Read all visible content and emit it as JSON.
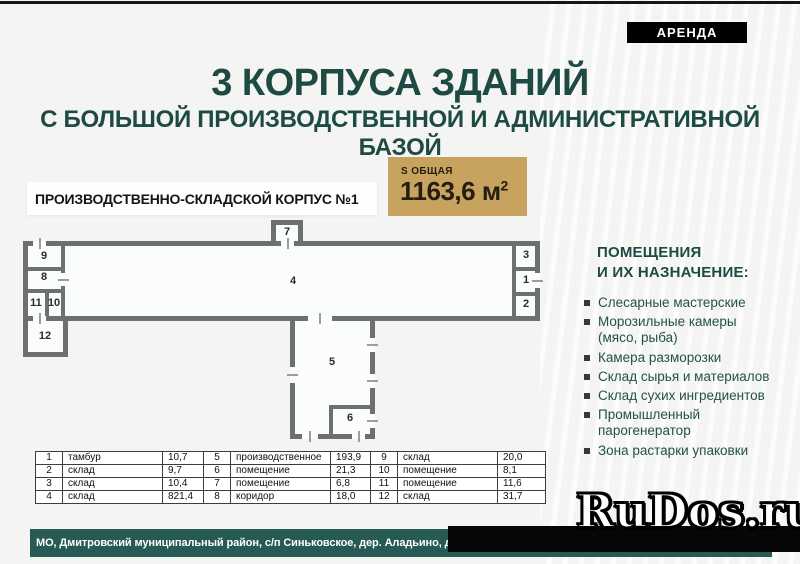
{
  "top": {
    "rent_badge": "АРЕНДА"
  },
  "header": {
    "title": "3 КОРПУСА ЗДАНИЙ",
    "subtitle": "С БОЛЬШОЙ ПРОИЗВОДСТВЕННОЙ И АДМИНИСТРАТИВНОЙ БАЗОЙ"
  },
  "building": {
    "name": "ПРОИЗВОДСТВЕННО-СКЛАДСКОЙ КОРПУС №1",
    "area_caption": "S ОБЩАЯ",
    "area_value": "1163,6 м",
    "area_sup": "2"
  },
  "floor_plan": {
    "room_labels": [
      "1",
      "2",
      "3",
      "4",
      "5",
      "6",
      "7",
      "8",
      "9",
      "10",
      "11",
      "12"
    ]
  },
  "legend": {
    "title_line1": "ПОМЕЩЕНИЯ",
    "title_line2": "И ИХ НАЗНАЧЕНИЕ:",
    "items": [
      "Слесарные мастерские",
      "Морозильные камеры (мясо, рыба)",
      "Камера разморозки",
      "Склад сырья и материалов",
      "Склад сухих ингредиентов",
      "Промышленный парогенератор",
      "Зона растарки упаковки"
    ]
  },
  "tables": [
    {
      "rows": [
        [
          "1",
          "тамбур",
          "10,7"
        ],
        [
          "2",
          "склад",
          "9,7"
        ],
        [
          "3",
          "склад",
          "10,4"
        ],
        [
          "4",
          "склад",
          "821,4"
        ]
      ]
    },
    {
      "rows": [
        [
          "5",
          "производственное",
          "193,9"
        ],
        [
          "6",
          "помещение",
          "21,3"
        ],
        [
          "7",
          "помещение",
          "6,8"
        ],
        [
          "8",
          "коридор",
          "18,0"
        ]
      ]
    },
    {
      "rows": [
        [
          "9",
          "склад",
          "20,0"
        ],
        [
          "10",
          "помещение",
          "8,1"
        ],
        [
          "11",
          "помещение",
          "11,6"
        ],
        [
          "12",
          "склад",
          "31,7"
        ]
      ]
    }
  ],
  "footer": {
    "address": "МО, Дмитровский муниципальный район, с/п Синьковское, дер. Аладьино, д.1 |",
    "watermark": "RuDos.ru"
  },
  "colors": {
    "accent_teal": "#1e4a44",
    "gold": "#c7a35f",
    "wall_gray": "#6d7070",
    "footer_teal": "#275955",
    "badge_black": "#000000"
  }
}
